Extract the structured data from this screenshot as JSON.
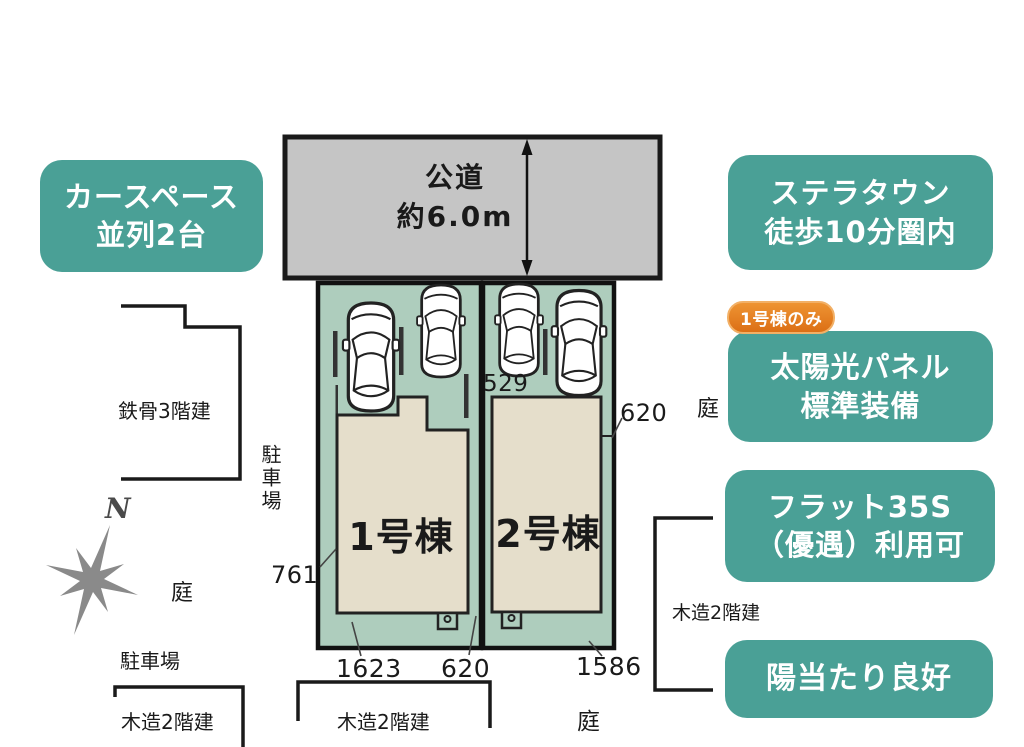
{
  "colors": {
    "teal": "#4aa096",
    "badge_orange": "#e1771c",
    "road_gray": "#c5c5c5",
    "plot_green": "#aecdbd",
    "building_beige": "#e5decb",
    "line_black": "#1a1a1a",
    "compass_gray": "#8a8a8a"
  },
  "road": {
    "name": "公道",
    "width_note": "約6.0m"
  },
  "plots": {
    "building1_label": "1号棟",
    "building2_label": "2号棟"
  },
  "dimensions": {
    "top_inner": "529",
    "right": "620",
    "left": "761",
    "bottom_left": "1623",
    "bottom_center": "620",
    "bottom_right": "1586"
  },
  "surroundings": {
    "steel_building": "鉄骨3階建",
    "parking_side": "駐車場",
    "garden_left": "庭",
    "parking_bottom": "駐車場",
    "wood_bottom_left": "木造2階建",
    "wood_bottom_center": "木造2階建",
    "garden_bottom": "庭",
    "wood_right": "木造2階建",
    "garden_right": "庭"
  },
  "compass": {
    "north_label": "N"
  },
  "callouts": {
    "car_space_line1": "カースペース",
    "car_space_line2": "並列2台",
    "stella_line1": "ステラタウン",
    "stella_line2": "徒歩10分圏内",
    "badge": "1号棟のみ",
    "solar_line1": "太陽光パネル",
    "solar_line2": "標準装備",
    "flat_line1": "フラット35S",
    "flat_line2": "（優遇）利用可",
    "sunny": "陽当たり良好"
  }
}
